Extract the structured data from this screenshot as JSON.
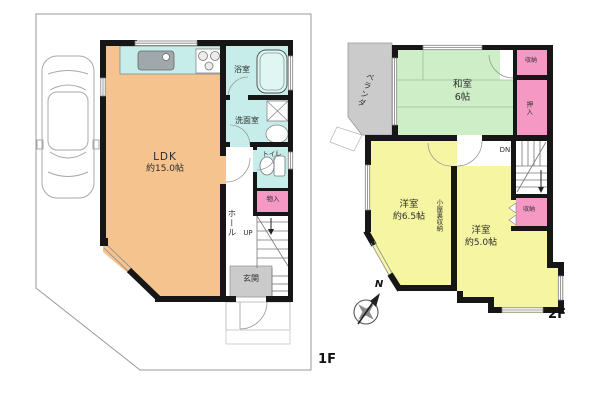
{
  "floor1": {
    "floor_label": "1F",
    "ldk_name": "LDK",
    "ldk_size": "約15.0帖",
    "bath": "浴室",
    "washroom": "洗面室",
    "toilet": "トイレ",
    "storage": "物入",
    "hall": "ホール",
    "stairs_direction": "UP",
    "entrance": "玄関"
  },
  "floor2": {
    "floor_label": "2F",
    "veranda": "ベランダ",
    "washitsu_name": "和室",
    "washitsu_size": "6帖",
    "closet_upper": "収納",
    "oshiire": "押入",
    "stairs_direction": "DN",
    "western1_name": "洋室",
    "western1_size": "約6.5帖",
    "western2_name": "洋室",
    "western2_size": "約5.0帖",
    "attic_storage": "小屋裏収納",
    "closet_lower": "収納"
  },
  "compass": {
    "north": "N"
  },
  "colors": {
    "ldk": "#F5C38E",
    "wet_area": "#C6EDE9",
    "fixture": "#DFF6F3",
    "tatami": "#CDEEC6",
    "western": "#F6F5A1",
    "closet": "#F598C3",
    "gray_area": "#CBCBCB",
    "wall": "#161616"
  }
}
